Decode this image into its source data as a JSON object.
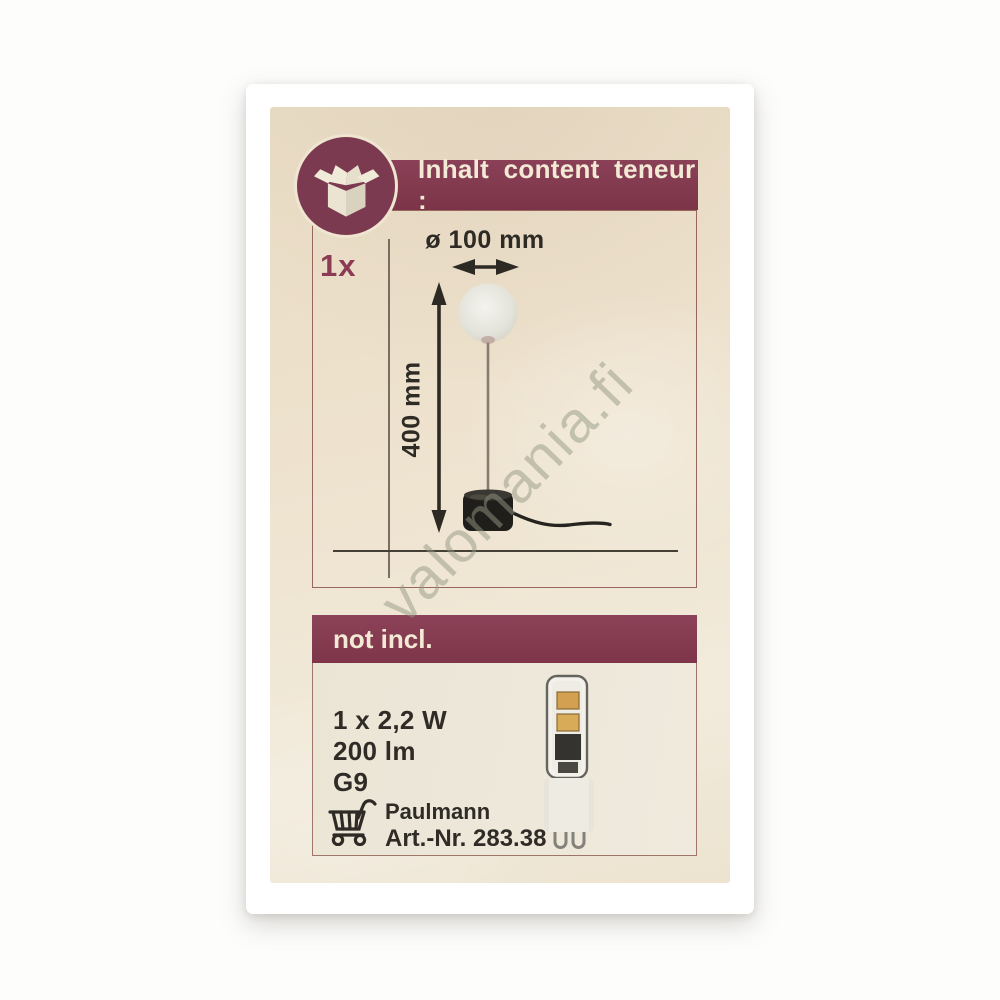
{
  "photo": {
    "watermark": "valomania.fi"
  },
  "label": {
    "colors": {
      "maroon": "#82344c",
      "cream_background": "#ece1cb",
      "cream_text": "#f3ead6",
      "dark_text": "#2f2c27"
    },
    "content": {
      "icon": "open-box-icon",
      "header": "Inhalt content teneur :",
      "quantity": "1x",
      "diagram": {
        "diameter_label": "ø 100 mm",
        "height_label": "400 mm",
        "subject": "globe table lamp with black base and cord"
      }
    },
    "not_included": {
      "header": "not incl.",
      "specs": [
        "1 x 2,2 W",
        "200 lm",
        "G9"
      ],
      "icon": "shopping-cart-icon",
      "brand": "Paulmann",
      "article_number": "Art.-Nr. 283.38",
      "bulb_image": "G9 LED capsule bulb"
    }
  }
}
